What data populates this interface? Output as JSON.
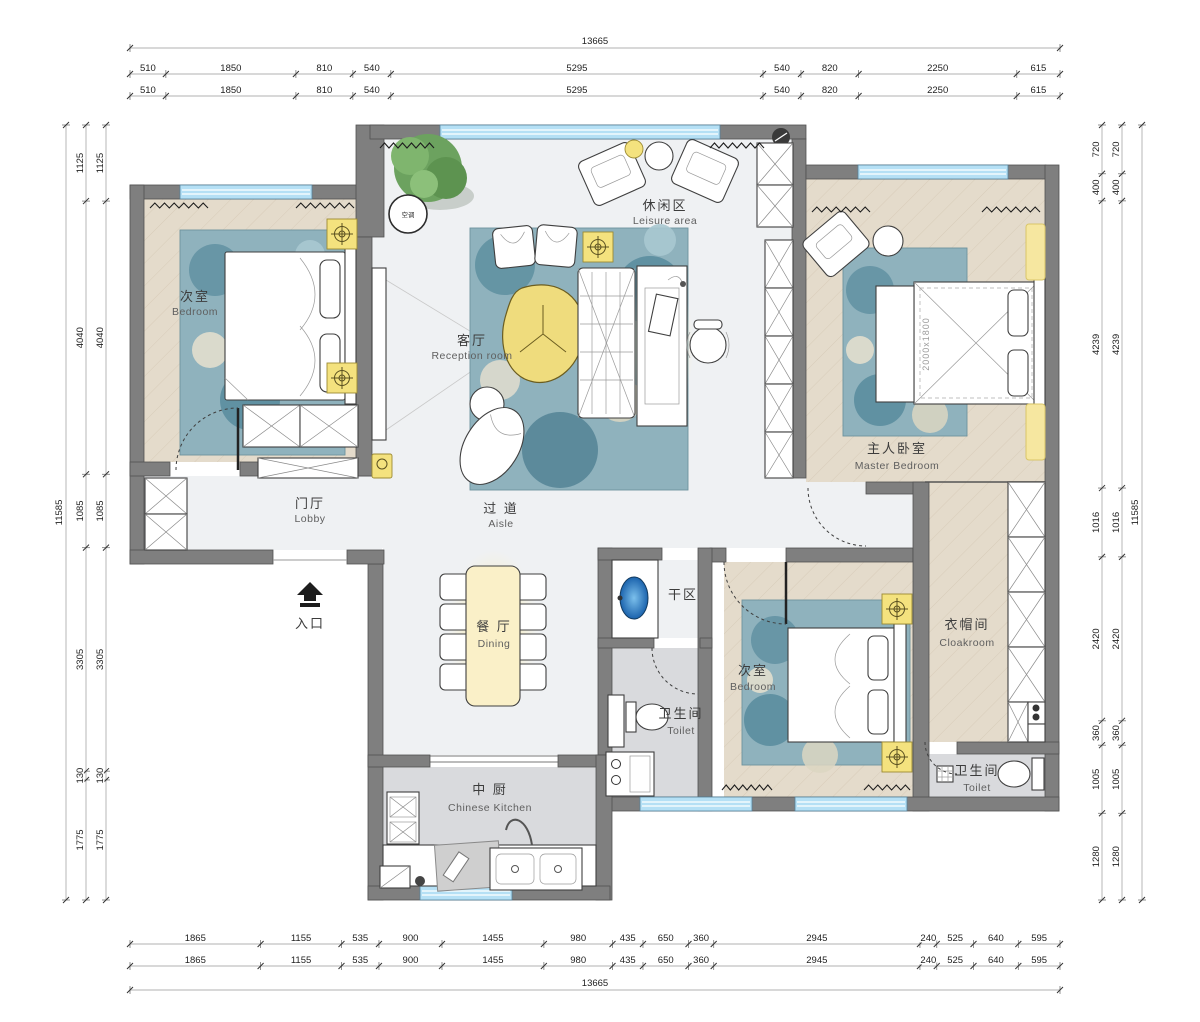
{
  "rooms": [
    {
      "id": "bedroom-left",
      "zh": "次室",
      "en": "Bedroom"
    },
    {
      "id": "leisure-area",
      "zh": "休闲区",
      "en": "Leisure area"
    },
    {
      "id": "reception",
      "zh": "客厅",
      "en": "Reception  room"
    },
    {
      "id": "master-bedroom",
      "zh": "主人卧室",
      "en": "Master Bedroom"
    },
    {
      "id": "lobby",
      "zh": "门厅",
      "en": "Lobby"
    },
    {
      "id": "aisle",
      "zh": "过 道",
      "en": "Aisle"
    },
    {
      "id": "dining",
      "zh": "餐 厅",
      "en": "Dining"
    },
    {
      "id": "dry-area",
      "zh": "干区",
      "en": ""
    },
    {
      "id": "toilet-1",
      "zh": "卫生间",
      "en": "Toilet"
    },
    {
      "id": "bedroom-2",
      "zh": "次室",
      "en": "Bedroom"
    },
    {
      "id": "cloakroom",
      "zh": "衣帽间",
      "en": "Cloakroom"
    },
    {
      "id": "toilet-2",
      "zh": "卫生间",
      "en": "Toilet"
    },
    {
      "id": "kitchen",
      "zh": "中 厨",
      "en": "Chinese Kitchen"
    },
    {
      "id": "entrance",
      "zh": "入口",
      "en": ""
    }
  ],
  "annotations": {
    "bed_size": "2000x1800",
    "ac_label": "空调"
  },
  "dimensions": {
    "top": {
      "total": "13665",
      "segments": [
        "510",
        "1850",
        "810",
        "540",
        "5295",
        "540",
        "820",
        "2250",
        "615"
      ]
    },
    "bottom": {
      "total": "13665",
      "segments": [
        "1865",
        "1155",
        "535",
        "900",
        "1455",
        "980",
        "435",
        "650",
        "360",
        "2945",
        "240",
        "525",
        "640",
        "595"
      ]
    },
    "left": {
      "total": "11585",
      "segments": [
        "1125",
        "4040",
        "1085",
        "3305",
        "130",
        "1775"
      ]
    },
    "right": {
      "total": "11585",
      "segments": [
        "720",
        "400",
        "4239",
        "1016",
        "2420",
        "360",
        "1005",
        "1280"
      ]
    }
  },
  "colors": {
    "wall": "#7f7f7f",
    "window": "#b5e0f5",
    "light_fixture": "#f4e27e",
    "rug": "#8fb2bd",
    "wood_floor": "#e4dbcb",
    "marble_floor": "#eff1f3",
    "tile_floor": "#d9dadd",
    "sink_blue": "#2b7fd0",
    "tree_green": "#6ca25f"
  }
}
